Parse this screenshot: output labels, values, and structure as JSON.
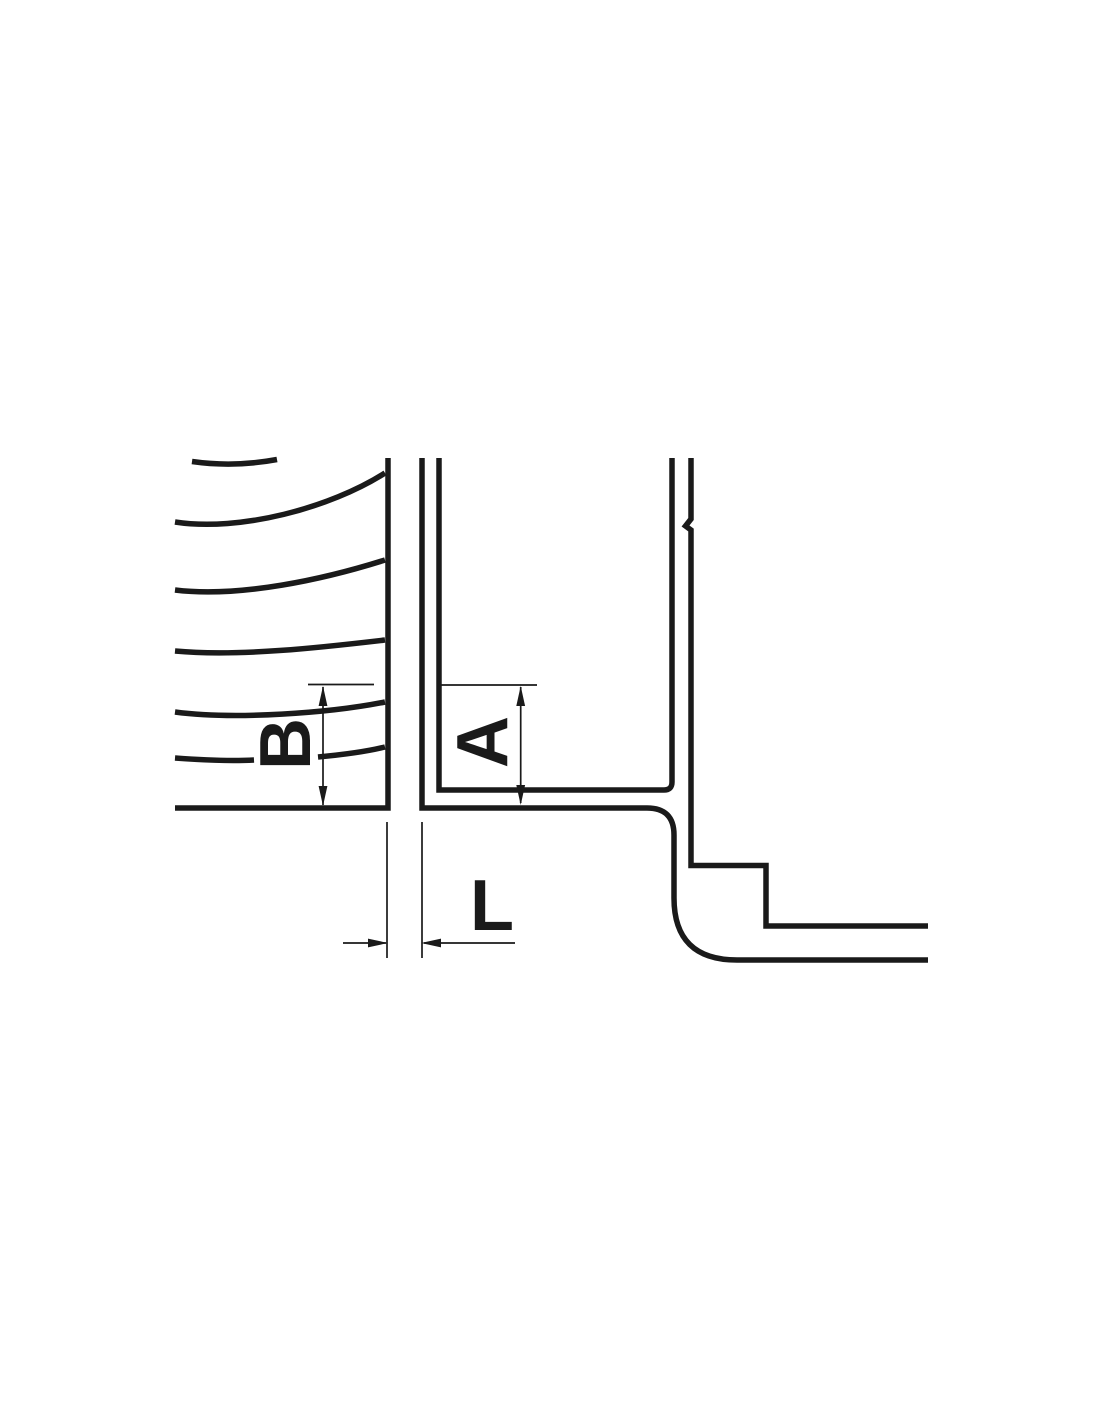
{
  "page": {
    "background": "#ffffff"
  },
  "drawing": {
    "type": "engineering-section-view",
    "line_color": "#1a1a1a",
    "labels": {
      "depth_left": "B",
      "depth_right": "A",
      "gap_width": "L"
    }
  }
}
